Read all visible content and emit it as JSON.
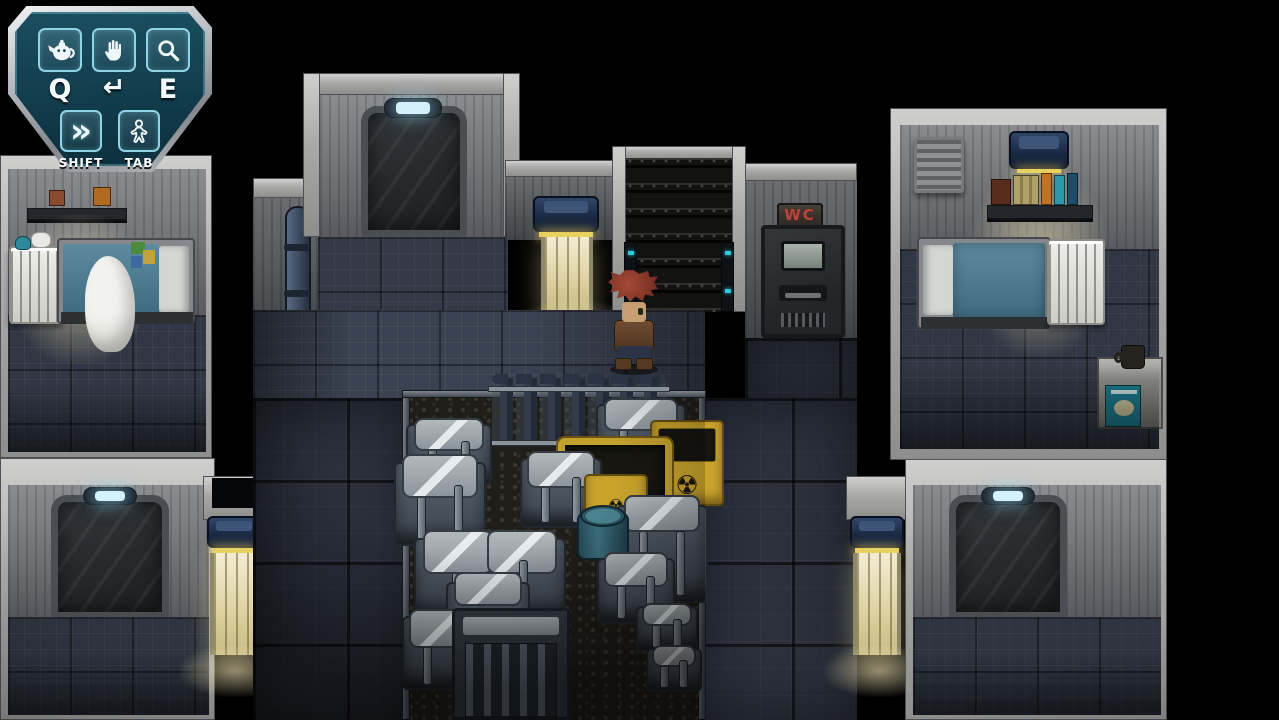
{
  "game": {
    "description": "pixel-art sci-fi crew-quarters interior with storage hold",
    "hud": {
      "slots": [
        {
          "icon": "teapot-item-icon",
          "key_label": "Q"
        },
        {
          "icon": "hand-interact-icon",
          "key_label": "↵"
        },
        {
          "icon": "magnifier-examine-icon",
          "key_label": "E"
        },
        {
          "icon": "fast-forward-icon",
          "key_label": "SHIFT"
        },
        {
          "icon": "person-menu-icon",
          "key_label": "TAB"
        }
      ],
      "panel_color": "#12485a",
      "frame_color": "#c7ccd0",
      "icon_color": "#eef8fb"
    },
    "signs": {
      "wc": "WC",
      "wc_color": "#b6463c",
      "radiation": "☢"
    },
    "scene": {
      "rooms": [
        "left-bedroom",
        "right-bedroom",
        "bottom-left-room",
        "bottom-right-room",
        "top-corridor",
        "staircase",
        "wc-toilet",
        "storage-hold"
      ],
      "objects": [
        "bed",
        "blanket",
        "crib",
        "radiator",
        "wall-shelf",
        "books",
        "ceiling-lamp",
        "sliding-door",
        "lit-doorway",
        "stairs",
        "gas-cylinder-rack",
        "cargo-crates",
        "hazard-crates",
        "barred-cabinet",
        "barrel",
        "nightstand",
        "mug",
        "vent",
        "pipe-capsule"
      ],
      "character": {
        "role": "player-character",
        "hair_color": "#9a4434",
        "jacket_color": "#64452c",
        "pants_color": "#2c3444"
      },
      "palette": {
        "background": "#000000",
        "wall_frame": "#b2b2b0",
        "wall_panel": "#74767a",
        "corridor_floor": "#3a4150",
        "dark_tile_wall": "#2c313d",
        "storage_floor": "#201e19",
        "door": "#2c2f33",
        "lamp_glow": "#d4f0fa",
        "doorway_light": "#e9dfb2",
        "crate_body": "#525a66",
        "crate_lid": "#a6adb2",
        "hazard_yellow": "#c9a32c",
        "mattress_teal": "#4e7e92"
      }
    }
  }
}
